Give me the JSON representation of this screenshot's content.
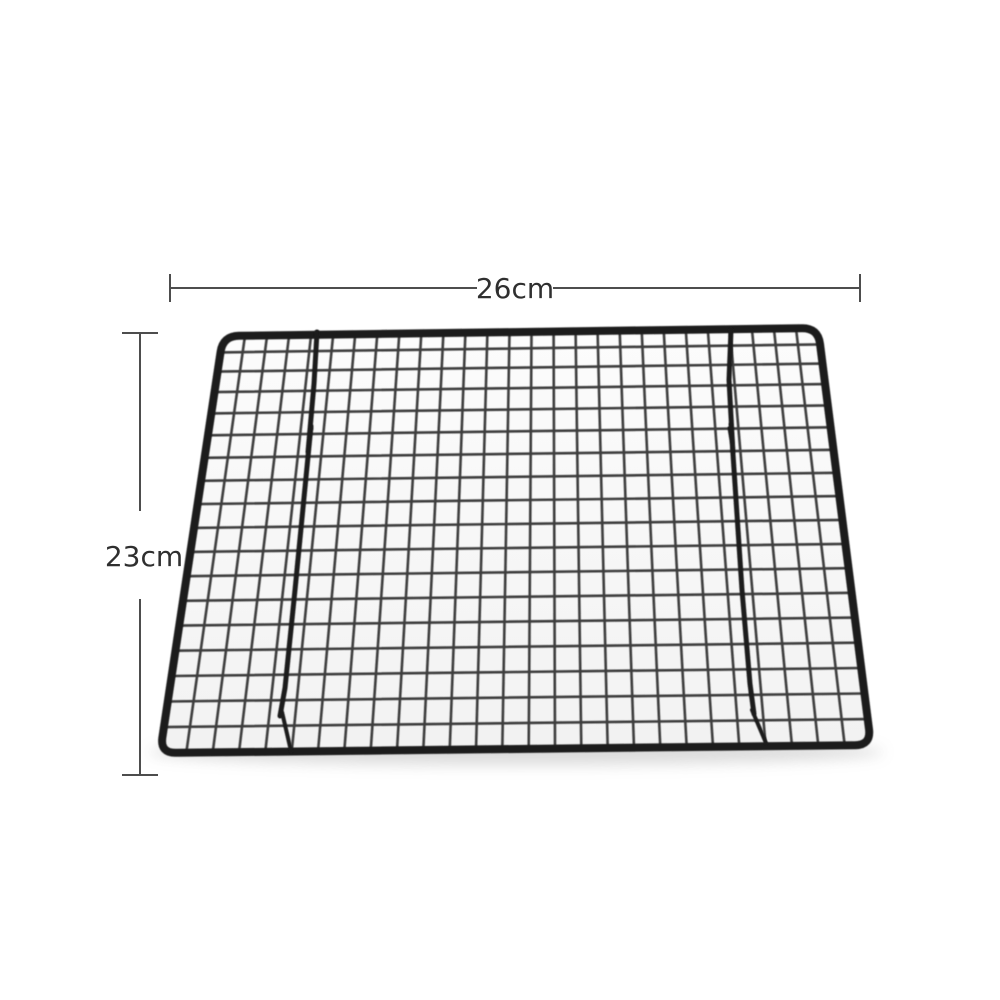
{
  "image": {
    "type": "product-dimension-photo",
    "subject": "black metal wire cooling rack grid shown in perspective on white background"
  },
  "annotations": {
    "width_label": "26cm",
    "height_label": "23cm"
  },
  "product": {
    "grid_columns": 27,
    "grid_rows": 18,
    "visible_leg_wires": 2
  },
  "colors": {
    "background": "#ffffff",
    "wire": "#2e2e2e",
    "frame": "#1f1f1f",
    "leg": "#1b1b1b",
    "dimension_line": "#4d4d4d",
    "label_text": "#2f2f2f",
    "interior_top": "#fcfcfc",
    "interior_bottom": "#f2f2f2",
    "shadow": "#9a9a9a"
  }
}
